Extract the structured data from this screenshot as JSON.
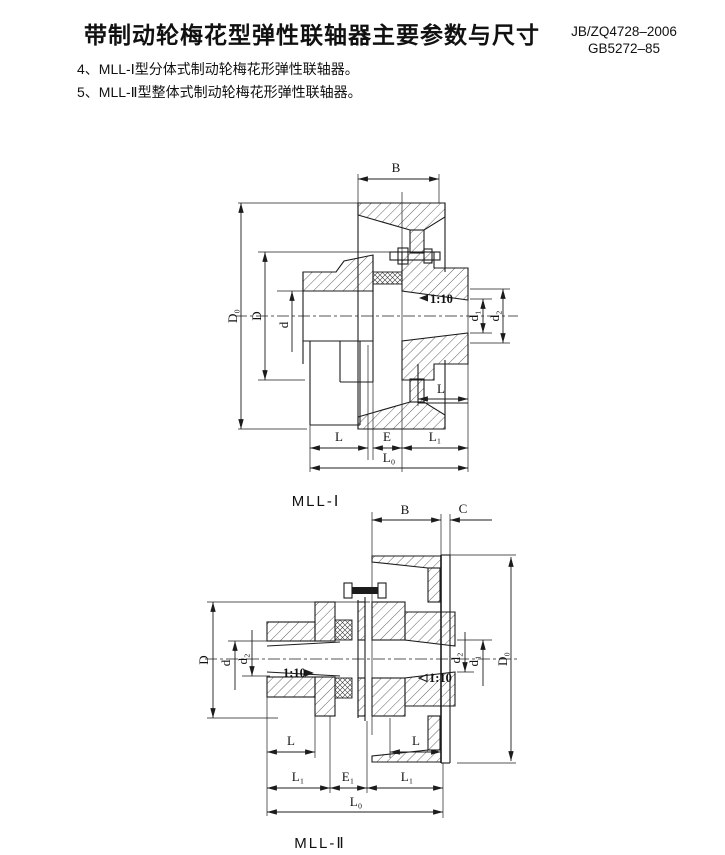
{
  "page": {
    "title": "带制动轮梅花型弹性联轴器主要参数与尺寸",
    "standards": [
      "JB/ZQ4728–2006",
      "GB5272–85"
    ],
    "notes": [
      "4、MLL-Ⅰ型分体式制动轮梅花形弹性联轴器。",
      "5、MLL-Ⅱ型整体式制动轮梅花形弹性联轴器。"
    ]
  },
  "figure1": {
    "caption": "MLL-Ⅰ",
    "labels": {
      "B": "B",
      "D0": "D₀",
      "D": "D",
      "d": "d",
      "taper": "1:10",
      "d1": "d₁",
      "d2": "d₂",
      "L_hub_right": "L",
      "L": "L",
      "E": "E",
      "L1": "L₁",
      "L0": "L₀"
    }
  },
  "figure2": {
    "caption": "MLL-Ⅱ",
    "labels": {
      "B": "B",
      "C": "C",
      "D": "D",
      "d": "d",
      "d2_left": "d₂",
      "taper_left": "1:10",
      "taper_right": "1:10",
      "d2_right": "d₂",
      "d1": "d₁",
      "D0": "D₀",
      "L_left": "L",
      "L_right": "L",
      "L1_left": "L₁",
      "E1": "E₁",
      "L1_right": "L₁",
      "L0": "L₀"
    }
  },
  "colors": {
    "ink": "#1c1c1c",
    "paper": "#ffffff"
  }
}
